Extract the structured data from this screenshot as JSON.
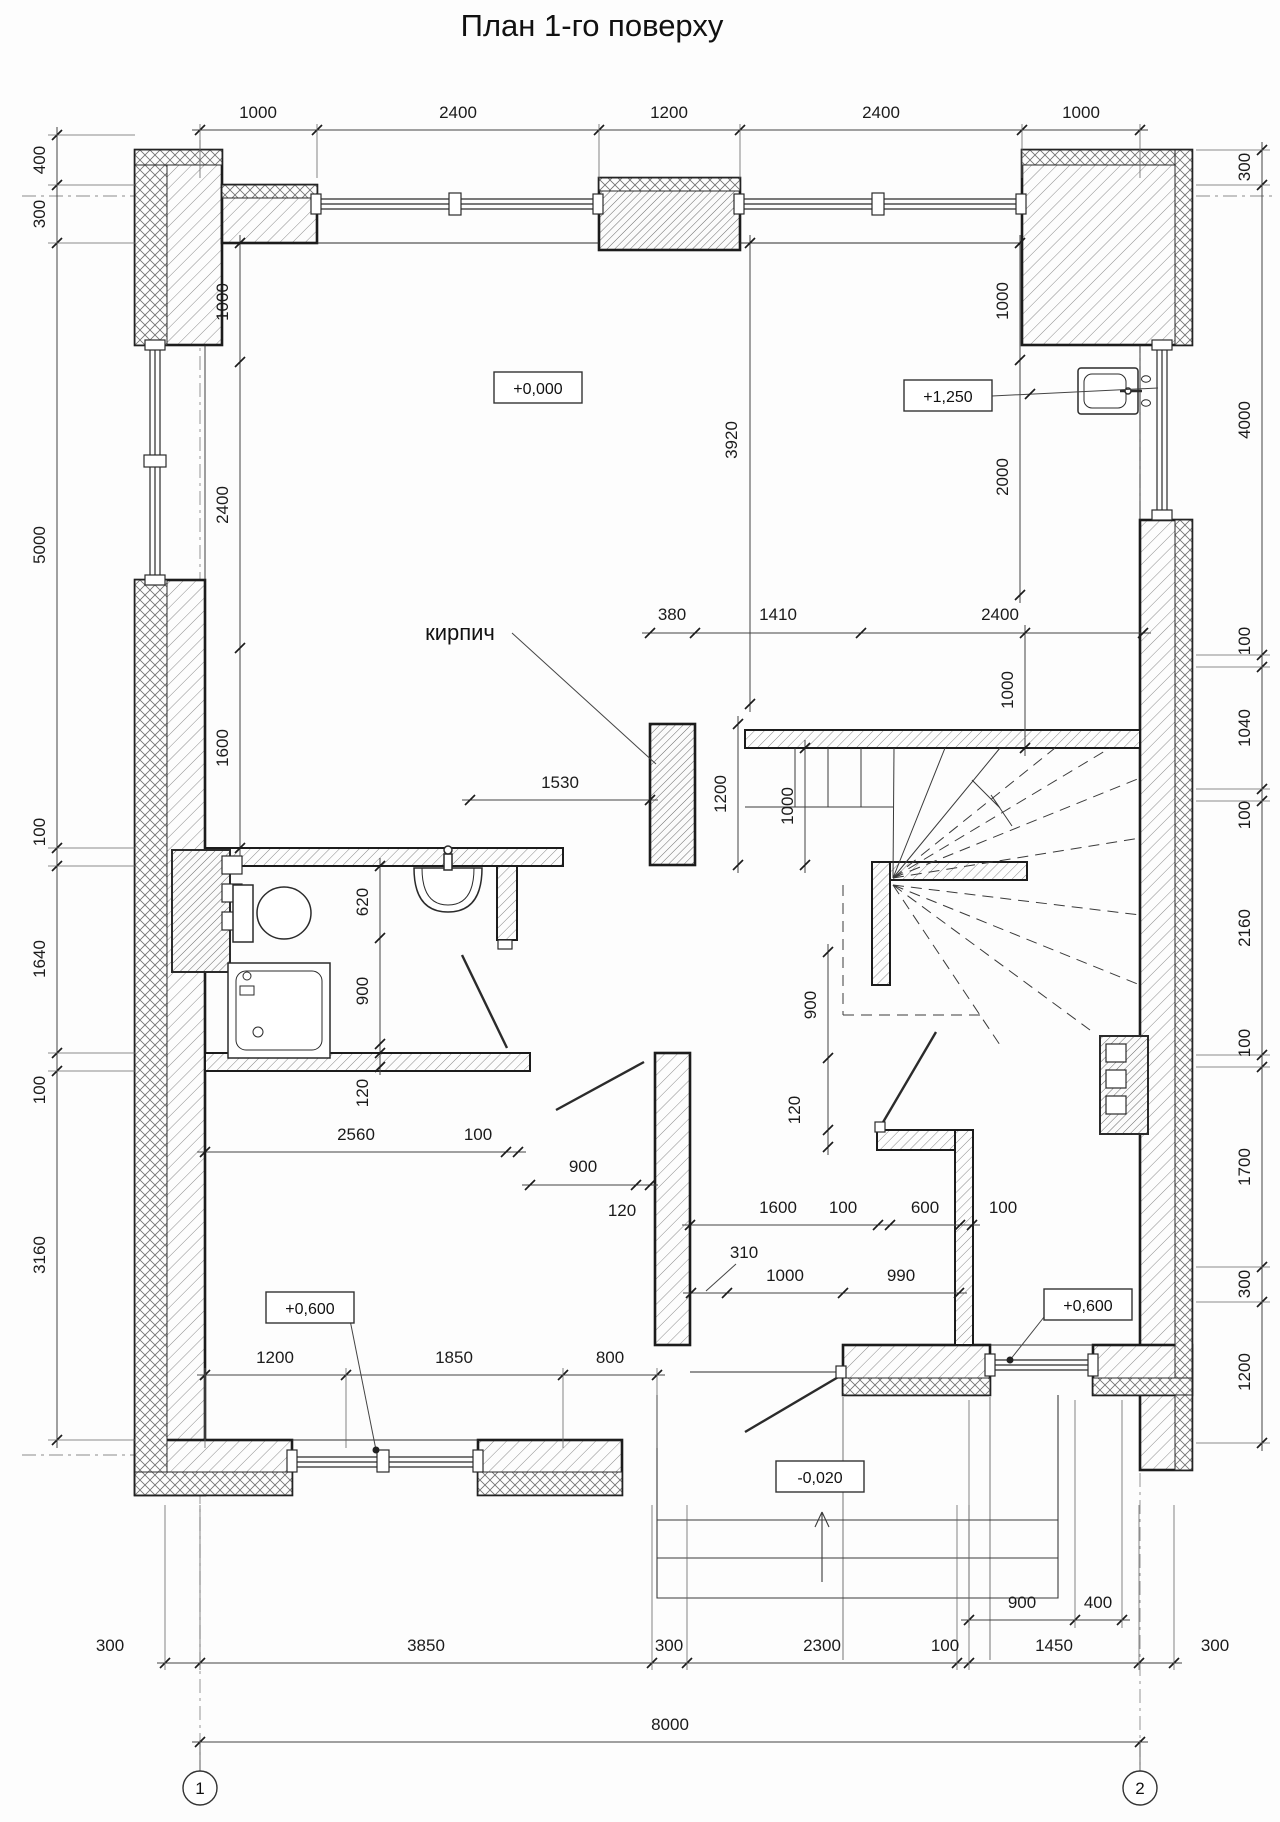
{
  "title": "План 1-го поверху",
  "labels": {
    "brick": "кирпич"
  },
  "levels": [
    {
      "t": "+0,000",
      "x": 538,
      "y": 388
    },
    {
      "t": "+1,250",
      "x": 948,
      "y": 396
    },
    {
      "t": "+0,600",
      "x": 310,
      "y": 1308
    },
    {
      "t": "+0,600",
      "x": 1088,
      "y": 1305
    },
    {
      "t": "-0,020",
      "x": 820,
      "y": 1477
    }
  ],
  "axes": {
    "bubble_y": 1788,
    "items": [
      {
        "t": "1",
        "x": 200,
        "top": 140
      },
      {
        "t": "2",
        "x": 1140,
        "top": 150
      }
    ]
  },
  "dim_chains": [
    {
      "name": "top",
      "dir": "h",
      "line": 130,
      "ticks": [
        200,
        317,
        599,
        740,
        1022,
        1140
      ],
      "ext": [
        178,
        124
      ],
      "texts": [
        {
          "t": "1000",
          "x": 258,
          "y": 118
        },
        {
          "t": "2400",
          "x": 458,
          "y": 118
        },
        {
          "t": "1200",
          "x": 669,
          "y": 118
        },
        {
          "t": "2400",
          "x": 881,
          "y": 118
        },
        {
          "t": "1000",
          "x": 1081,
          "y": 118
        }
      ]
    },
    {
      "name": "left",
      "dir": "v",
      "line": 57,
      "ticks": [
        135,
        185,
        243,
        848,
        866,
        1053,
        1071,
        1440
      ],
      "ext": [
        48,
        135
      ],
      "texts": [
        {
          "t": "400",
          "x": 45,
          "y": 160
        },
        {
          "t": "300",
          "x": 45,
          "y": 214
        },
        {
          "t": "5000",
          "x": 45,
          "y": 545
        },
        {
          "t": "100",
          "x": 45,
          "y": 832
        },
        {
          "t": "1640",
          "x": 45,
          "y": 959
        },
        {
          "t": "100",
          "x": 45,
          "y": 1090
        },
        {
          "t": "3160",
          "x": 45,
          "y": 1255
        }
      ]
    },
    {
      "name": "right",
      "dir": "v",
      "line": 1262,
      "ticks": [
        150,
        185,
        655,
        667,
        789,
        801,
        1055,
        1067,
        1267,
        1302,
        1443
      ],
      "ext": [
        1196,
        1270
      ],
      "texts": [
        {
          "t": "300",
          "x": 1250,
          "y": 167
        },
        {
          "t": "4000",
          "x": 1250,
          "y": 420
        },
        {
          "t": "100",
          "x": 1250,
          "y": 641
        },
        {
          "t": "1040",
          "x": 1250,
          "y": 728
        },
        {
          "t": "100",
          "x": 1250,
          "y": 815
        },
        {
          "t": "2160",
          "x": 1250,
          "y": 928
        },
        {
          "t": "100",
          "x": 1250,
          "y": 1043
        },
        {
          "t": "1700",
          "x": 1250,
          "y": 1167
        },
        {
          "t": "300",
          "x": 1250,
          "y": 1284
        },
        {
          "t": "1200",
          "x": 1250,
          "y": 1372
        }
      ]
    },
    {
      "name": "bottom",
      "dir": "h",
      "line": 1663,
      "ticks": [
        165,
        200,
        652,
        687,
        957,
        969,
        1139,
        1174
      ],
      "ext": [
        1505,
        1670
      ],
      "texts": [
        {
          "t": "300",
          "x": 110,
          "y": 1651
        },
        {
          "t": "3850",
          "x": 426,
          "y": 1651
        },
        {
          "t": "300",
          "x": 669,
          "y": 1651
        },
        {
          "t": "2300",
          "x": 822,
          "y": 1651
        },
        {
          "t": "100",
          "x": 945,
          "y": 1651
        },
        {
          "t": "1450",
          "x": 1054,
          "y": 1651
        },
        {
          "t": "300",
          "x": 1215,
          "y": 1651
        }
      ]
    },
    {
      "name": "bottom-sub",
      "dir": "h",
      "line": 1620,
      "ticks": [
        969,
        1075,
        1122
      ],
      "ext": [
        1400,
        1628
      ],
      "texts": [
        {
          "t": "900",
          "x": 1022,
          "y": 1608
        },
        {
          "t": "400",
          "x": 1098,
          "y": 1608
        }
      ]
    },
    {
      "name": "total",
      "dir": "h",
      "line": 1742,
      "ticks": [
        200,
        1140
      ],
      "ext": null,
      "texts": [
        {
          "t": "8000",
          "x": 670,
          "y": 1730
        }
      ]
    },
    {
      "name": "room-left",
      "dir": "v",
      "line": 240,
      "ticks": [
        243,
        362,
        648,
        848
      ],
      "ext": null,
      "texts": [
        {
          "t": "1000",
          "x": 228,
          "y": 302
        },
        {
          "t": "2400",
          "x": 228,
          "y": 505
        },
        {
          "t": "1600",
          "x": 228,
          "y": 748
        }
      ]
    },
    {
      "name": "d3920",
      "dir": "v",
      "line": 750,
      "ticks": [
        243,
        704
      ],
      "ext": null,
      "texts": [
        {
          "t": "3920",
          "x": 737,
          "y": 440
        }
      ]
    },
    {
      "name": "mid",
      "dir": "h",
      "line": 633,
      "ticks": [
        650,
        695,
        861,
        1143
      ],
      "ext": null,
      "texts": [
        {
          "t": "380",
          "x": 672,
          "y": 620
        },
        {
          "t": "1410",
          "x": 778,
          "y": 620
        },
        {
          "t": "2400",
          "x": 1000,
          "y": 620
        }
      ]
    },
    {
      "name": "pier-h",
      "dir": "v",
      "line": 738,
      "ticks": [
        724,
        865
      ],
      "ext": null,
      "texts": [
        {
          "t": "1200",
          "x": 726,
          "y": 794
        }
      ]
    },
    {
      "name": "stair-l",
      "dir": "v",
      "line": 805,
      "ticks": [
        748,
        865
      ],
      "ext": null,
      "texts": [
        {
          "t": "1000",
          "x": 793,
          "y": 806
        }
      ]
    },
    {
      "name": "stair-r",
      "dir": "v",
      "line": 1025,
      "ticks": [
        633,
        748
      ],
      "ext": null,
      "texts": [
        {
          "t": "1000",
          "x": 1013,
          "y": 690
        }
      ]
    },
    {
      "name": "ur",
      "dir": "v",
      "line": 1020,
      "ticks": [
        243,
        360,
        595
      ],
      "ext": null,
      "texts": [
        {
          "t": "1000",
          "x": 1008,
          "y": 301
        },
        {
          "t": "2000",
          "x": 1008,
          "y": 477
        }
      ]
    },
    {
      "name": "d1530",
      "dir": "h",
      "line": 800,
      "ticks": [
        470,
        650
      ],
      "ext": null,
      "texts": [
        {
          "t": "1530",
          "x": 560,
          "y": 788
        }
      ]
    },
    {
      "name": "bath",
      "dir": "v",
      "line": 380,
      "ticks": [
        866,
        938,
        1044,
        1053,
        1067
      ],
      "ext": null,
      "texts": [
        {
          "t": "620",
          "x": 368,
          "y": 902
        },
        {
          "t": "900",
          "x": 368,
          "y": 991
        },
        {
          "t": "120",
          "x": 368,
          "y": 1093
        }
      ]
    },
    {
      "name": "c2560",
      "dir": "h",
      "line": 1152,
      "ticks": [
        205,
        506,
        518
      ],
      "ext": null,
      "texts": [
        {
          "t": "2560",
          "x": 356,
          "y": 1140
        },
        {
          "t": "100",
          "x": 478,
          "y": 1140
        }
      ]
    },
    {
      "name": "c900d",
      "dir": "h",
      "line": 1185,
      "ticks": [
        530,
        636,
        650
      ],
      "ext": null,
      "texts": [
        {
          "t": "900",
          "x": 583,
          "y": 1172
        },
        {
          "t": "120",
          "x": 622,
          "y": 1216
        }
      ]
    },
    {
      "name": "c900v",
      "dir": "v",
      "line": 828,
      "ticks": [
        952,
        1058,
        1130,
        1147
      ],
      "ext": null,
      "texts": [
        {
          "t": "900",
          "x": 816,
          "y": 1005
        },
        {
          "t": "120",
          "x": 800,
          "y": 1110
        }
      ]
    },
    {
      "name": "c1600",
      "dir": "h",
      "line": 1225,
      "ticks": [
        690,
        878,
        890,
        960,
        972
      ],
      "ext": null,
      "texts": [
        {
          "t": "1600",
          "x": 778,
          "y": 1213
        },
        {
          "t": "100",
          "x": 843,
          "y": 1213
        },
        {
          "t": "600",
          "x": 925,
          "y": 1213
        },
        {
          "t": "100",
          "x": 1003,
          "y": 1213
        }
      ]
    },
    {
      "name": "c1000",
      "dir": "h",
      "line": 1293,
      "ticks": [
        691,
        727,
        843,
        959
      ],
      "ext": null,
      "texts": [
        {
          "t": "310",
          "x": 744,
          "y": 1258
        },
        {
          "t": "1000",
          "x": 785,
          "y": 1281
        },
        {
          "t": "990",
          "x": 901,
          "y": 1281
        }
      ]
    },
    {
      "name": "room-bl",
      "dir": "h",
      "line": 1375,
      "ticks": [
        205,
        346,
        563,
        657
      ],
      "ext": [
        1368,
        1448
      ],
      "texts": [
        {
          "t": "1200",
          "x": 275,
          "y": 1363
        },
        {
          "t": "1850",
          "x": 454,
          "y": 1363
        },
        {
          "t": "800",
          "x": 610,
          "y": 1363
        }
      ]
    }
  ],
  "leaders": [
    {
      "name": "brick-leader",
      "pts": [
        [
          512,
          633
        ],
        [
          656,
          764
        ]
      ]
    },
    {
      "name": "level-1250-leader",
      "pts": [
        [
          992,
          396
        ],
        [
          1158,
          388
        ]
      ],
      "tick": [
        1030,
        394
      ]
    },
    {
      "name": "level-0600-left-leader",
      "pts": [
        [
          350,
          1320
        ],
        [
          376,
          1450
        ]
      ],
      "dot": true
    },
    {
      "name": "level-0600-right-leader",
      "pts": [
        [
          1048,
          1312
        ],
        [
          1010,
          1360
        ]
      ],
      "dot": true
    },
    {
      "name": "d310-leader",
      "pts": [
        [
          736,
          1264
        ],
        [
          706,
          1291
        ]
      ]
    }
  ]
}
